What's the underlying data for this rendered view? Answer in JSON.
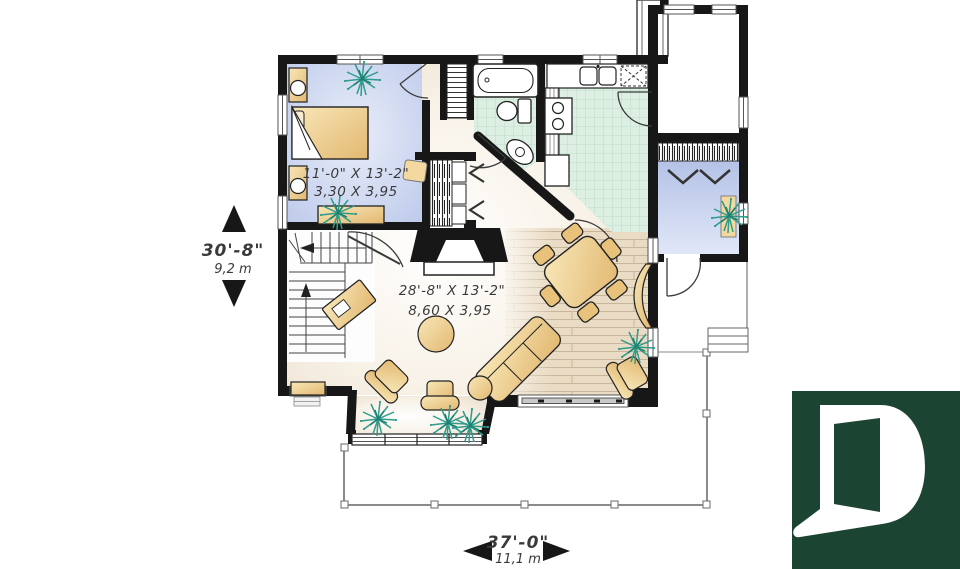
{
  "rooms": {
    "bedroom": {
      "imperial": "11'-0\" X 13'-2\"",
      "metric": "3,30 X 3,95"
    },
    "great_room": {
      "imperial": "28'-8\" X 13'-2\"",
      "metric": "8,60 X 3,95"
    }
  },
  "dimensions": {
    "depth": {
      "imperial": "30'-8\"",
      "metric": "9,2 m"
    },
    "width": {
      "imperial": "37'-0\"",
      "metric": "11,1 m"
    }
  },
  "logo": {
    "letter": "D"
  },
  "colors": {
    "wall": "#171717",
    "furniture": "#eed096",
    "plant": "#2f9c8c",
    "bedroom_floor": "#c7d2ec",
    "tile_floor": "#dcefe2",
    "wood_floor": "#e9dbc4",
    "logo_green": "#1c4433"
  }
}
